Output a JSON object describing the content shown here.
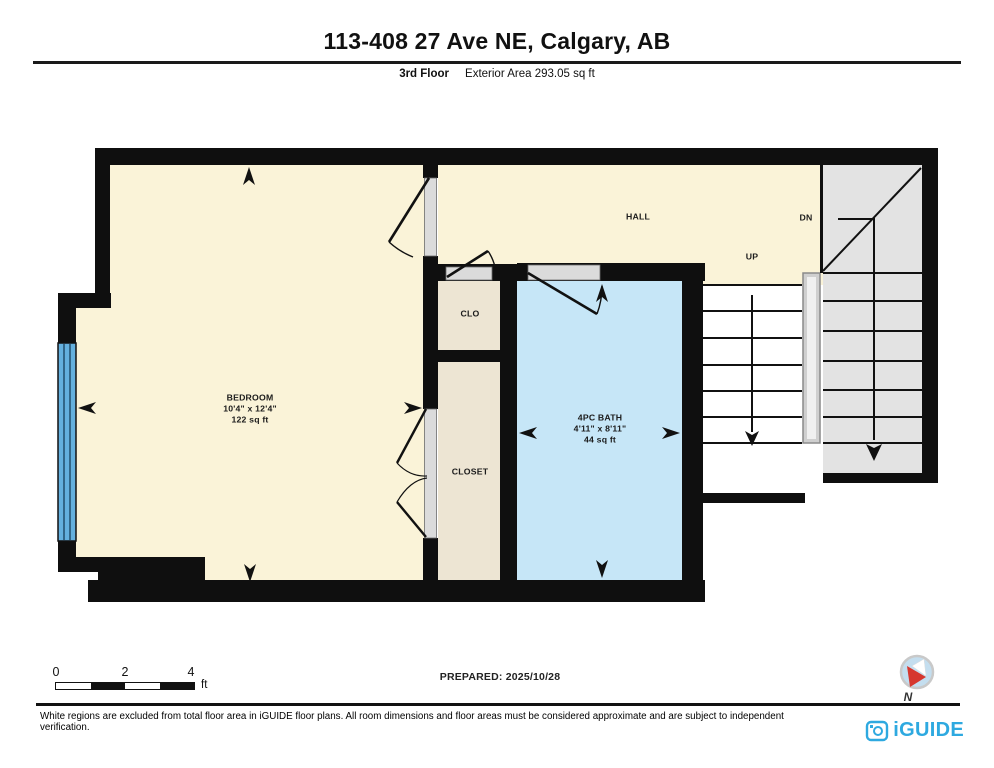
{
  "header": {
    "title": "113-408 27 Ave NE, Calgary, AB",
    "floor": "3rd Floor",
    "area": "Exterior Area 293.05 sq ft"
  },
  "plan": {
    "bedroom": {
      "name": "BEDROOM",
      "dims": "10'4\" x 12'4\"",
      "area": "122 sq ft"
    },
    "bath": {
      "name": "4PC BATH",
      "dims": "4'11\" x 8'11\"",
      "area": "44 sq ft"
    },
    "clo": "CLO",
    "closet": "CLOSET",
    "hall": "HALL",
    "up": "UP",
    "dn": "DN"
  },
  "scale_bar": {
    "tick0": "0",
    "tick2": "2",
    "tick4": "4",
    "unit": "ft"
  },
  "compass": {
    "north": "N"
  },
  "footer": {
    "prepared": "PREPARED: 2025/10/28",
    "disclaimer": "White regions are excluded from total floor area in iGUIDE floor plans. All room dimensions and floor areas must be considered approximate and are subject to independent verification.",
    "brand": "iGUIDE"
  },
  "colors": {
    "room_cream": "#FAF3D8",
    "room_tan": "#EDE5D3",
    "room_blue": "#C6E6F7",
    "window_blue": "#64B0DE",
    "stair_gray": "#E3E3E3",
    "door_opening_gray": "#DBDBDB",
    "wall_black": "#0F0F0F",
    "brand_blue": "#2EA9E0",
    "compass_red": "#D6372E"
  }
}
